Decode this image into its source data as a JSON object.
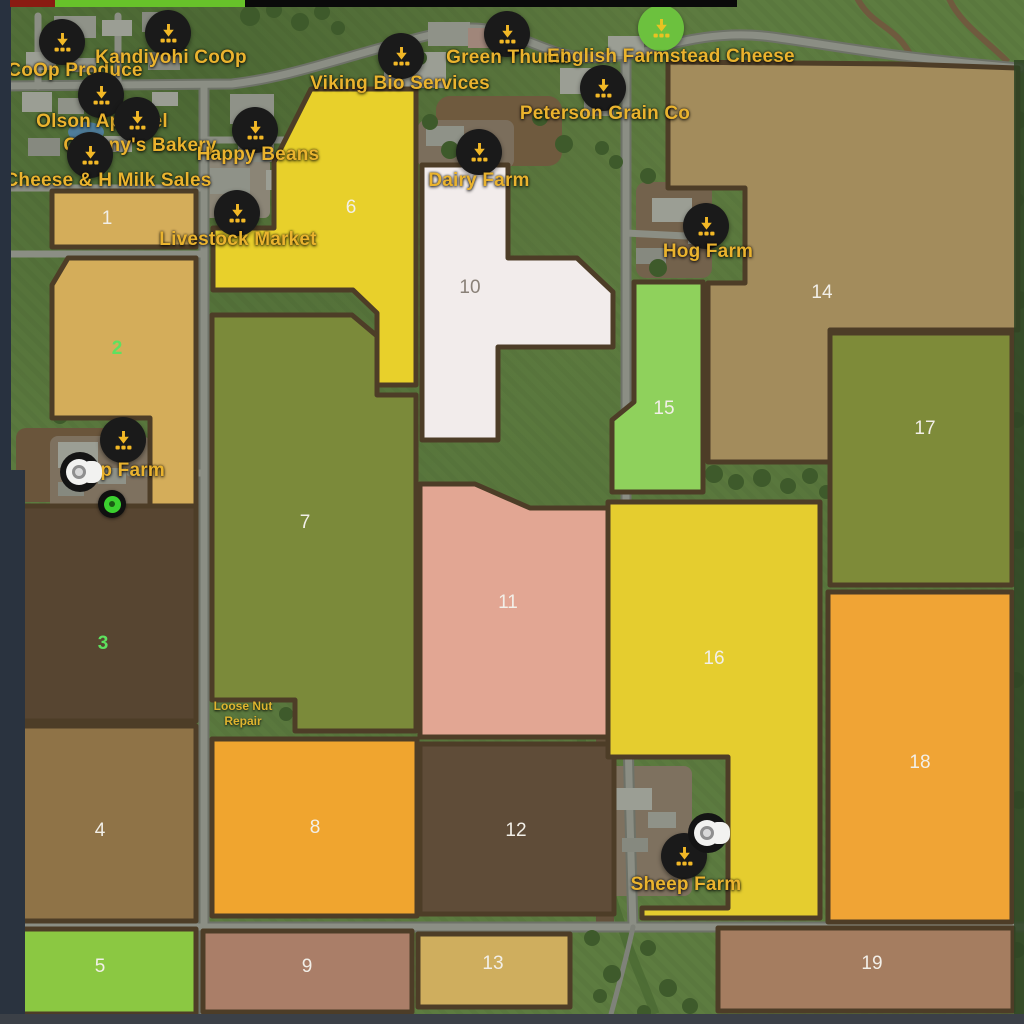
{
  "map": {
    "name": "farm-map-overview",
    "fields": [
      {
        "number": "1",
        "color": "#d4ad5a",
        "number_color": "#f2efe8",
        "nx": 107,
        "ny": 218,
        "points": "52,191 196,191 196,247 52,247"
      },
      {
        "number": "2",
        "color": "#d4ad5a",
        "number_color": "#5ee15f",
        "nx": 117,
        "ny": 348,
        "points": "68,258 196,258 196,510 150,510 150,418 52,418 52,285"
      },
      {
        "number": "3",
        "color": "#574531",
        "number_color": "#5ee15f",
        "nx": 103,
        "ny": 643,
        "points": "15,506 196,506 196,721 15,721"
      },
      {
        "number": "4",
        "color": "#8f7347",
        "number_color": "#f2efe8",
        "nx": 100,
        "ny": 830,
        "points": "15,726 196,726 196,921 15,921"
      },
      {
        "number": "5",
        "color": "#8bc842",
        "number_color": "#f2efe8",
        "nx": 100,
        "ny": 966,
        "points": "15,929 196,929 196,1014 15,1014"
      },
      {
        "number": "6",
        "color": "#e8d02b",
        "number_color": "#f2efe8",
        "nx": 351,
        "ny": 207,
        "points": "311,89 416,89 416,385 377,385 377,313 353,290 213,290 213,228 274,228 274,162"
      },
      {
        "number": "7",
        "color": "#7b8a3a",
        "number_color": "#f2efe8",
        "nx": 305,
        "ny": 522,
        "points": "212,315 352,315 377,336 377,395 416,395 416,731 295,731 295,700 212,700"
      },
      {
        "number": "8",
        "color": "#f0a52f",
        "number_color": "#f2efe8",
        "nx": 315,
        "ny": 827,
        "points": "212,739 417,739 417,916 212,916"
      },
      {
        "number": "9",
        "color": "#aa7e68",
        "number_color": "#f2efe8",
        "nx": 307,
        "ny": 966,
        "points": "203,931 412,931 412,1012 203,1012"
      },
      {
        "number": "10",
        "color": "#f2eceb",
        "number_color": "#8a8178",
        "nx": 470,
        "ny": 287,
        "points": "422,165 508,165 508,258 577,258 613,292 613,347 498,347 498,440 422,440"
      },
      {
        "number": "11",
        "color": "#e2a693",
        "number_color": "#f2efe8",
        "nx": 508,
        "ny": 602,
        "points": "420,484 475,484 530,508 608,508 608,737 420,737"
      },
      {
        "number": "12",
        "color": "#5f4c38",
        "number_color": "#f2efe8",
        "nx": 516,
        "ny": 830,
        "points": "420,744 614,744 614,914 420,914"
      },
      {
        "number": "13",
        "color": "#cfae5e",
        "number_color": "#f2efe8",
        "nx": 493,
        "ny": 963,
        "points": "418,934 570,934 570,1007 418,1007"
      },
      {
        "number": "14",
        "color": "#a38c5c",
        "number_color": "#f2efe8",
        "nx": 822,
        "ny": 292,
        "points": "668,62 900,64 1018,68 1018,330 830,330 830,462 708,462 708,283 745,283 745,188 668,188"
      },
      {
        "number": "15",
        "color": "#8fd15c",
        "number_color": "#f2efe8",
        "nx": 664,
        "ny": 408,
        "points": "634,282 703,282 703,492 612,492 612,420 634,402"
      },
      {
        "number": "16",
        "color": "#e5cd2f",
        "number_color": "#f2efe8",
        "nx": 714,
        "ny": 658,
        "points": "608,502 820,502 820,918 642,918 642,908 728,908 728,757 608,757"
      },
      {
        "number": "17",
        "color": "#7e8b39",
        "number_color": "#f2efe8",
        "nx": 925,
        "ny": 428,
        "points": "830,333 1012,333 1012,585 830,585"
      },
      {
        "number": "18",
        "color": "#f0a435",
        "number_color": "#f2efe8",
        "nx": 920,
        "ny": 762,
        "points": "828,592 1012,592 1012,922 828,922"
      },
      {
        "number": "19",
        "color": "#a57d60",
        "number_color": "#f2efe8",
        "nx": 872,
        "ny": 963,
        "points": "718,928 1013,928 1013,1011 718,1011"
      }
    ],
    "sell_points": [
      {
        "slug": "coop-produce",
        "label": "CoOp Produce",
        "circle": "#1a1a1a",
        "glyph": "#f2b826",
        "ix": 62,
        "iy": 42,
        "lx": 75,
        "ly": 71
      },
      {
        "slug": "kandiyohi-coop",
        "label": "Kandiyohi CoOp",
        "circle": "#1a1a1a",
        "glyph": "#f2b826",
        "ix": 168,
        "iy": 33,
        "lx": 171,
        "ly": 58
      },
      {
        "slug": "viking-bio-services",
        "label": "Viking Bio Services",
        "circle": "#1a1a1a",
        "glyph": "#f2b826",
        "ix": 401,
        "iy": 56,
        "lx": 400,
        "ly": 84
      },
      {
        "slug": "green-thumb",
        "label": "Green Thumb",
        "circle": "#1a1a1a",
        "glyph": "#f2b826",
        "ix": 507,
        "iy": 34,
        "lx": 509,
        "ly": 58
      },
      {
        "slug": "english-farmstead-cheese",
        "label": "English Farmstead Cheese",
        "circle": "#6cc13e",
        "glyph": "#e8c322",
        "ix": 661,
        "iy": 28,
        "lx": 671,
        "ly": 57
      },
      {
        "slug": "peterson-grain-co",
        "label": "Peterson Grain Co",
        "circle": "#1a1a1a",
        "glyph": "#f2b826",
        "ix": 603,
        "iy": 88,
        "lx": 605,
        "ly": 114
      },
      {
        "slug": "olson-apparel",
        "label": "Olson Apparel",
        "circle": "#1a1a1a",
        "glyph": "#f2b826",
        "ix": 101,
        "iy": 95,
        "lx": 102,
        "ly": 122
      },
      {
        "slug": "grannys-bakery",
        "label": "Granny's Bakery",
        "circle": "#1a1a1a",
        "glyph": "#f2b826",
        "ix": 137,
        "iy": 120,
        "lx": 140,
        "ly": 146
      },
      {
        "slug": "happy-beans",
        "label": "Happy Beans",
        "circle": "#1a1a1a",
        "glyph": "#f2b826",
        "ix": 255,
        "iy": 130,
        "lx": 258,
        "ly": 155
      },
      {
        "slug": "cheese-h-milk-sales",
        "label": "Cheese & H Milk Sales",
        "circle": "#1a1a1a",
        "glyph": "#f2b826",
        "ix": 90,
        "iy": 155,
        "lx": 108,
        "ly": 181
      },
      {
        "slug": "livestock-market",
        "label": "Livestock Market",
        "circle": "#1a1a1a",
        "glyph": "#f2b826",
        "ix": 237,
        "iy": 213,
        "lx": 238,
        "ly": 240
      },
      {
        "slug": "dairy-farm",
        "label": "Dairy Farm",
        "circle": "#1a1a1a",
        "glyph": "#f2b826",
        "ix": 479,
        "iy": 152,
        "lx": 479,
        "ly": 181
      },
      {
        "slug": "hog-farm",
        "label": "Hog Farm",
        "circle": "#1a1a1a",
        "glyph": "#f2b826",
        "ix": 706,
        "iy": 226,
        "lx": 708,
        "ly": 252
      },
      {
        "slug": "crop-farm",
        "label": "Crop Farm",
        "circle": "#1a1a1a",
        "glyph": "#f2b826",
        "ix": 123,
        "iy": 440,
        "lx": 116,
        "ly": 471
      },
      {
        "slug": "sheep-farm",
        "label": "Sheep Farm",
        "circle": "#1a1a1a",
        "glyph": "#f2b826",
        "ix": 684,
        "iy": 856,
        "lx": 686,
        "ly": 885
      }
    ],
    "service_points": [
      {
        "slug": "loose-nut-repair",
        "lines": [
          "Loose Nut",
          "Repair"
        ],
        "x": 243,
        "y": 714
      }
    ],
    "vehicle_markers": [
      {
        "slug": "vehicle-marker-crop-farm",
        "x": 82,
        "y": 472
      },
      {
        "slug": "vehicle-marker-sheep-farm",
        "x": 710,
        "y": 833
      }
    ],
    "player_marker": {
      "x": 112,
      "y": 504
    },
    "status_bar": {
      "segments": [
        {
          "name": "segment-red",
          "color": "#8a1b12",
          "x": 10,
          "w": 45
        },
        {
          "name": "segment-green",
          "color": "#67c22a",
          "x": 55,
          "w": 190
        },
        {
          "name": "segment-black",
          "color": "#0a0a0a",
          "x": 245,
          "w": 492
        }
      ]
    },
    "field_border_color": "#4d3d27"
  }
}
